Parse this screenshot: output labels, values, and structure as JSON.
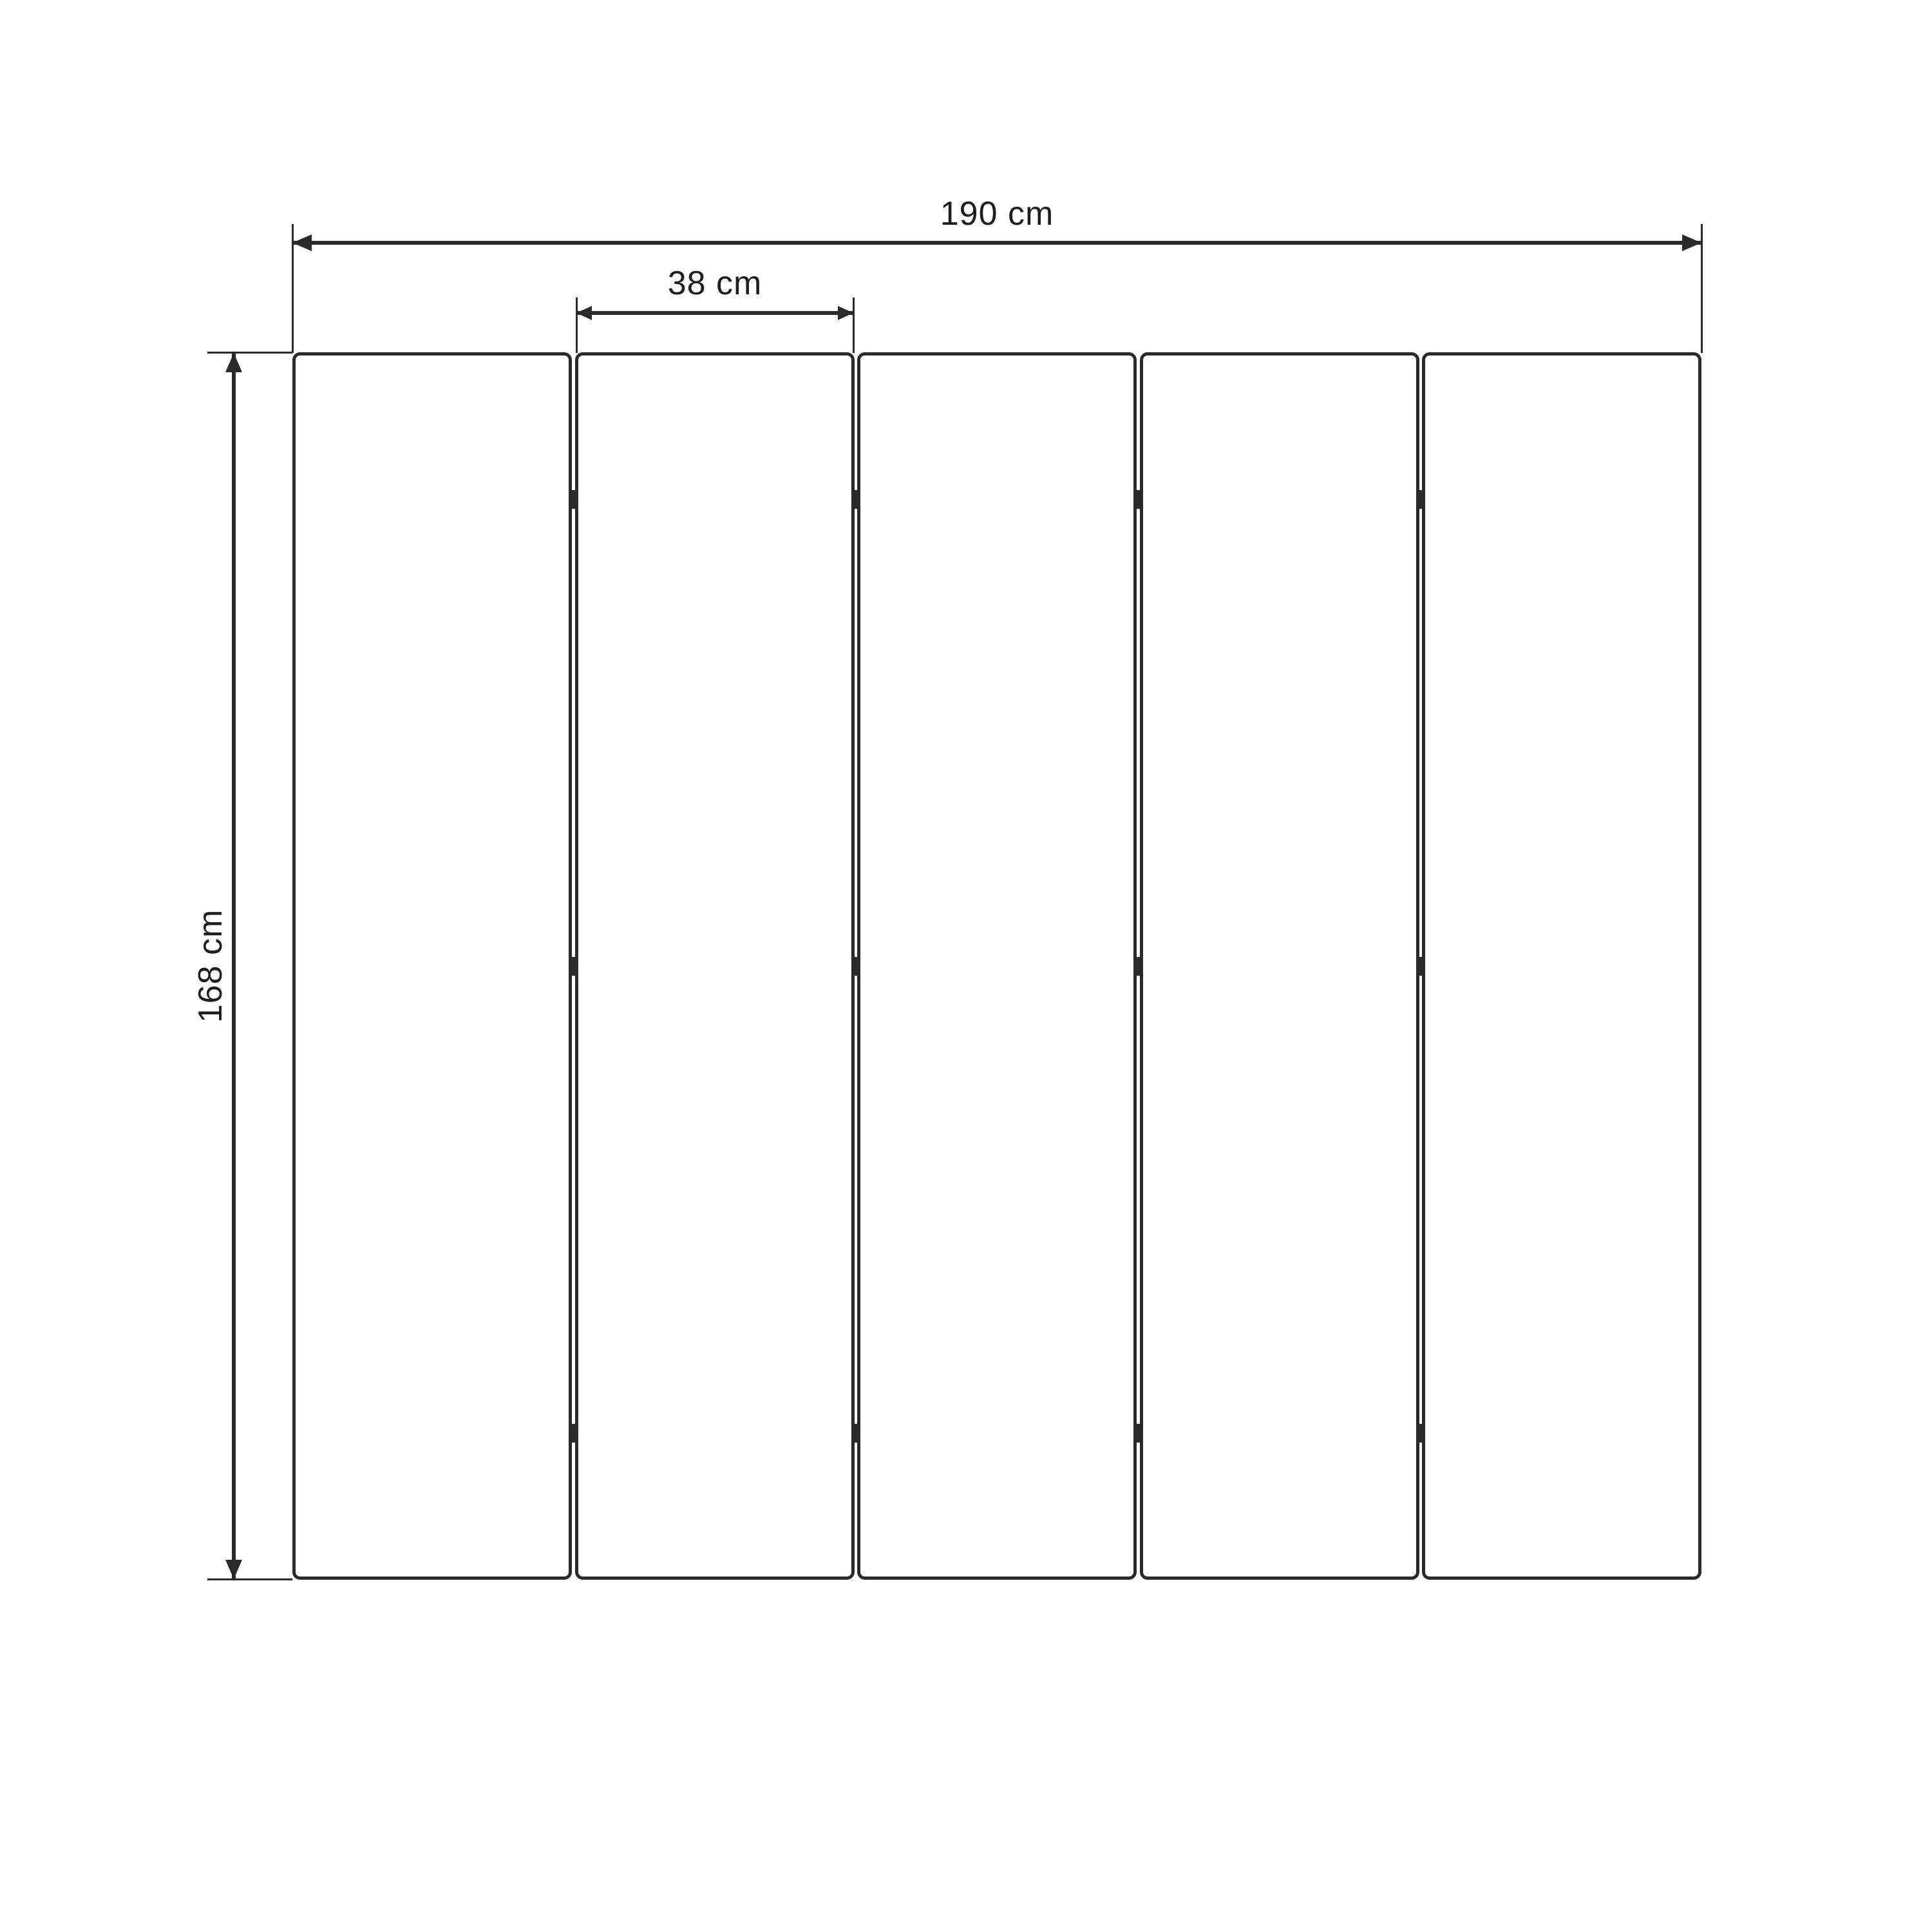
{
  "diagram": {
    "type": "dimension-drawing",
    "subject": "five-panel folding screen, front elevation",
    "panels": {
      "count": 5,
      "hinges_per_junction": 3
    },
    "dimensions": {
      "total_width": "190 cm",
      "panel_width": "38 cm",
      "height": "168 cm"
    },
    "colors": {
      "line": "#2a2a2a",
      "background": "#ffffff",
      "panel_fill": "#ffffff"
    }
  }
}
